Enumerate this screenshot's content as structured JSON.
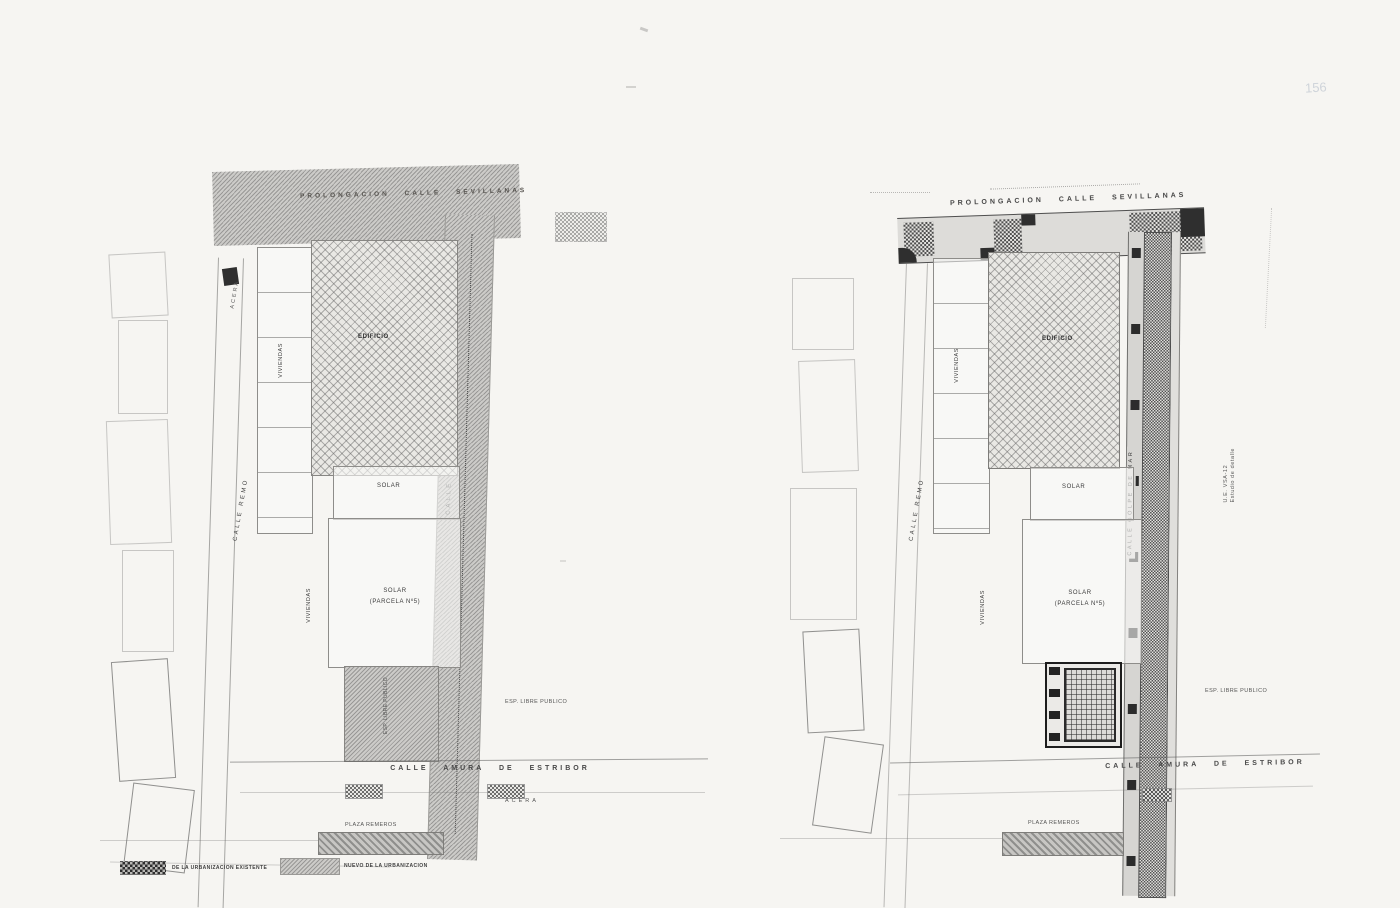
{
  "page": {
    "corner_mark": "156"
  },
  "left": {
    "street_top": "PROLONGACION CALLE SEVILLANAS",
    "acera_top": "ACERA",
    "calle_remo": "CALLE REMO",
    "calle_golpe": "CALLE GOLPE DE MAR",
    "viviendas_top": "VIVIENDAS",
    "edificio": "EDIFICIO",
    "solar": "SOLAR",
    "parcela_line1": "SOLAR",
    "parcela_line2": "(PARCELA Nº5)",
    "viviendas_bottom": "VIVIENDAS",
    "esp_libre_parcel": "ESP. LIBRE PUBLICO",
    "esp_libre": "ESP. LIBRE PUBLICO",
    "calle_amura": "CALLE AMURA DE ESTRIBOR",
    "acera_bottom": "ACERA",
    "plaza": "PLAZA REMEROS"
  },
  "right": {
    "street_top": "PROLONGACION CALLE SEVILLANAS",
    "calle_remo": "CALLE REMO",
    "calle_golpe": "CALLE GOLPE DE MAR",
    "viviendas_top": "VIVIENDAS",
    "edificio": "EDIFICIO",
    "solar": "SOLAR",
    "parcela_line1": "SOLAR",
    "parcela_line2": "(PARCELA Nº5)",
    "viviendas_bottom": "VIVIENDAS",
    "esp_libre": "ESP. LIBRE PUBLICO",
    "calle_amura": "CALLE AMURA DE ESTRIBOR",
    "plaza": "PLAZA REMEROS",
    "margin_note_line1": "U.E. VSA-12",
    "margin_note_line2": "Estudio de detalle"
  },
  "legend": {
    "items": [
      {
        "label": "DE LA URBANIZACION EXISTENTE"
      },
      {
        "label": "NUEVO DE LA URBANIZACION"
      }
    ]
  }
}
